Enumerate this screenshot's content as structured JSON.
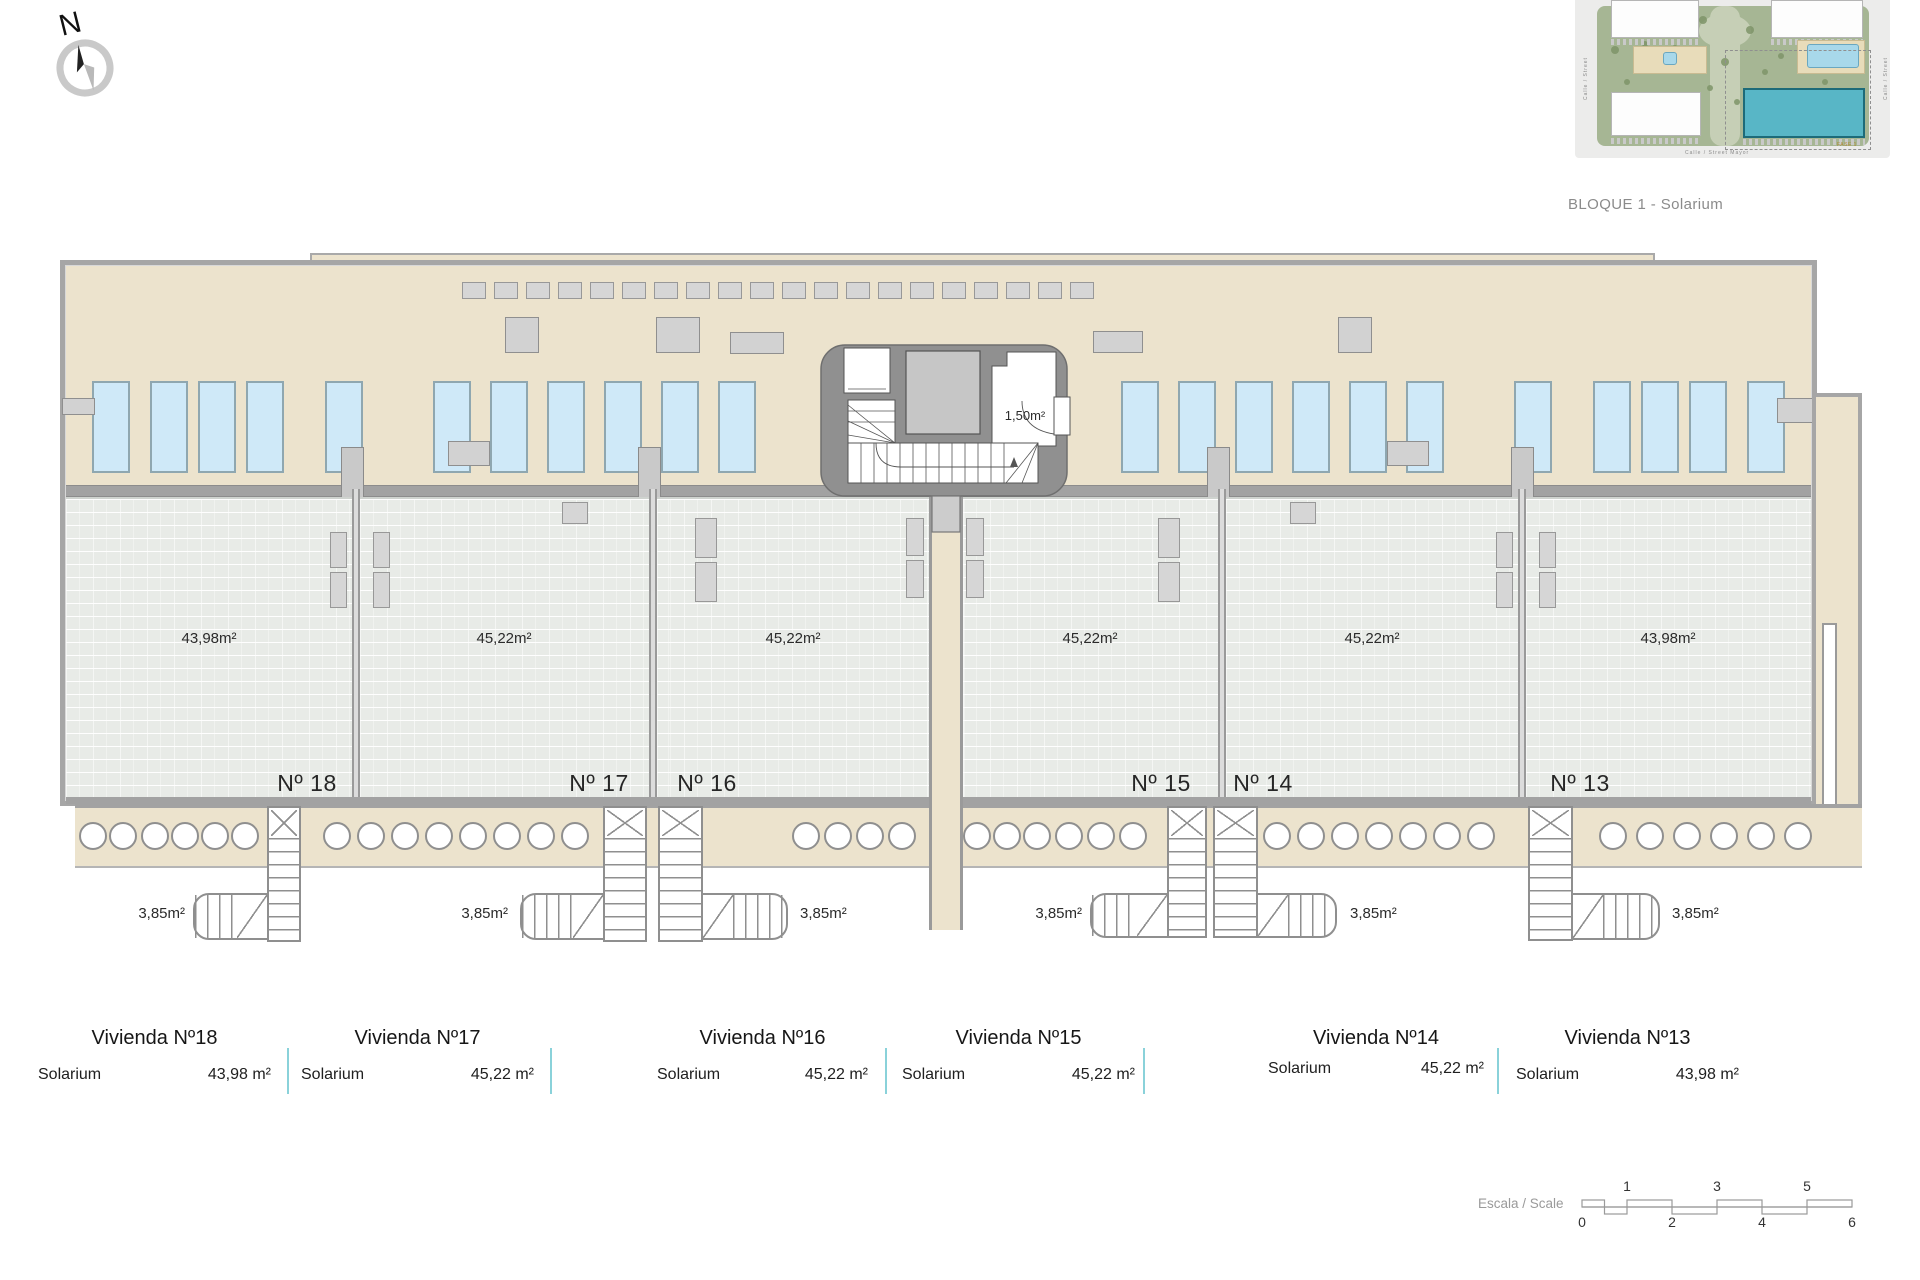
{
  "colors": {
    "beige": "#ece3cd",
    "brick": "#e8ebe7",
    "wall": "#a2a2a2",
    "pool_fill": "#cfe9f8",
    "pool_border": "#8fa7b0",
    "core_gray": "#909090",
    "table_divider": "#8ad2da",
    "caption_gray": "#8b8b8b"
  },
  "compass": {
    "label": "N"
  },
  "site_plan": {
    "caption": "BLOQUE 1 - Solarium",
    "streets": {
      "bottom": "Calle / Street  Mayor",
      "left": "Calle / Street",
      "right": "Calle / Street"
    },
    "phase_label": "FASE 1",
    "trees": [
      [
        40,
        50,
        4
      ],
      [
        52,
        82,
        3
      ],
      [
        128,
        20,
        4
      ],
      [
        150,
        62,
        4
      ],
      [
        162,
        102,
        3
      ],
      [
        175,
        30,
        4
      ],
      [
        190,
        72,
        3
      ],
      [
        206,
        56,
        3
      ],
      [
        60,
        120,
        4
      ],
      [
        100,
        48,
        3
      ],
      [
        120,
        116,
        4
      ],
      [
        250,
        82,
        3
      ],
      [
        212,
        122,
        3
      ],
      [
        284,
        62,
        3
      ],
      [
        70,
        44,
        3
      ],
      [
        240,
        34,
        3
      ],
      [
        95,
        95,
        3
      ],
      [
        135,
        88,
        3
      ]
    ]
  },
  "plan": {
    "shell": [
      60,
      260,
      1757,
      546
    ],
    "parapet": [
      310,
      253,
      1345,
      15
    ],
    "deck": [
      66,
      266,
      1745,
      219
    ],
    "wall_band": [
      66,
      485,
      1745,
      12
    ],
    "wall_bottom": [
      66,
      797,
      1745,
      7
    ],
    "right_wing": [
      1812,
      393,
      50,
      475
    ],
    "wing_slot": [
      1822,
      623,
      15,
      184
    ],
    "walkway": [
      75,
      804,
      1787,
      64
    ],
    "corridor": [
      929,
      490,
      34,
      440
    ],
    "pools": {
      "y": 381,
      "w": 38,
      "h": 92,
      "lefts": [
        92,
        150,
        198,
        246,
        325,
        433,
        490,
        547,
        604,
        661,
        718,
        1121,
        1178,
        1235,
        1292,
        1349,
        1406,
        1514,
        1593,
        1641,
        1689,
        1747
      ]
    },
    "loungers_top": {
      "start": 462,
      "y": 282,
      "w": 24,
      "h": 17,
      "pitch": 32,
      "count": 20
    },
    "deck_tables": [
      [
        505,
        317,
        34,
        36
      ],
      [
        656,
        317,
        44,
        36
      ],
      [
        730,
        332,
        54,
        22
      ],
      [
        1093,
        331,
        50,
        22
      ],
      [
        1338,
        317,
        34,
        36
      ],
      [
        62,
        398,
        33,
        17
      ],
      [
        1777,
        398,
        36,
        25
      ],
      [
        448,
        441,
        42,
        25
      ],
      [
        1387,
        441,
        42,
        25
      ]
    ],
    "divider_walls": [
      352,
      649,
      1218,
      1518
    ],
    "divider_pillars": [
      [
        341,
        447
      ],
      [
        638,
        447
      ],
      [
        1207,
        447
      ],
      [
        1511,
        447
      ]
    ],
    "terrace_items": [
      [
        330,
        532,
        17,
        36
      ],
      [
        330,
        572,
        17,
        36
      ],
      [
        373,
        532,
        17,
        36
      ],
      [
        373,
        572,
        17,
        36
      ],
      [
        695,
        518,
        22,
        40
      ],
      [
        695,
        562,
        22,
        40
      ],
      [
        906,
        518,
        18,
        38
      ],
      [
        906,
        560,
        18,
        38
      ],
      [
        966,
        518,
        18,
        38
      ],
      [
        966,
        560,
        18,
        38
      ],
      [
        1158,
        518,
        22,
        40
      ],
      [
        1158,
        562,
        22,
        40
      ],
      [
        1496,
        532,
        17,
        36
      ],
      [
        1496,
        572,
        17,
        36
      ],
      [
        1539,
        532,
        17,
        36
      ],
      [
        1539,
        572,
        17,
        36
      ],
      [
        562,
        502,
        26,
        22
      ],
      [
        1290,
        502,
        26,
        22
      ]
    ],
    "terraces": [
      {
        "x": 66,
        "w": 286,
        "area_label": "43,98m²",
        "area_cx": 209,
        "num_label": "Nº 18",
        "num_cx": 307
      },
      {
        "x": 360,
        "w": 289,
        "area_label": "45,22m²",
        "area_cx": 504,
        "num_label": "Nº 17",
        "num_cx": 599
      },
      {
        "x": 657,
        "w": 272,
        "area_label": "45,22m²",
        "area_cx": 793,
        "num_label": "Nº 16",
        "num_cx": 707
      },
      {
        "x": 963,
        "w": 255,
        "area_label": "45,22m²",
        "area_cx": 1090,
        "num_label": "Nº 15",
        "num_cx": 1161
      },
      {
        "x": 1226,
        "w": 292,
        "area_label": "45,22m²",
        "area_cx": 1372,
        "num_label": "Nº 14",
        "num_cx": 1263
      },
      {
        "x": 1526,
        "w": 285,
        "area_label": "43,98m²",
        "area_cx": 1668,
        "num_label": "Nº 13",
        "num_cx": 1580
      }
    ],
    "terrace_y": 497,
    "terrace_h": 303,
    "area_label_y": 630,
    "num_label_y": 770,
    "circles": {
      "cy": 836,
      "d": 28,
      "centers": [
        93,
        123,
        155,
        185,
        215,
        245,
        337,
        371,
        405,
        439,
        473,
        507,
        541,
        575,
        806,
        838,
        870,
        902,
        977,
        1007,
        1037,
        1069,
        1101,
        1133,
        1277,
        1311,
        1345,
        1379,
        1413,
        1447,
        1481,
        1613,
        1650,
        1687,
        1724,
        1761,
        1798
      ]
    },
    "stairs": [
      {
        "shaft": [
          267,
          806,
          34,
          136
        ],
        "run": [
          193,
          893,
          76,
          47
        ],
        "side": "left",
        "label": "3,85m²",
        "label_x": 185,
        "anchor": "end"
      },
      {
        "shaft": [
          603,
          806,
          44,
          136
        ],
        "run": [
          520,
          893,
          85,
          47
        ],
        "side": "left",
        "label": "3,85m²",
        "label_x": 508,
        "anchor": "end"
      },
      {
        "shaft": [
          658,
          806,
          45,
          136
        ],
        "run": [
          701,
          893,
          87,
          47
        ],
        "side": "right",
        "label": "3,85m²",
        "label_x": 800,
        "anchor": "start"
      },
      {
        "shaft": [
          1167,
          806,
          40,
          132
        ],
        "run": [
          1090,
          893,
          79,
          45
        ],
        "side": "left",
        "label": "3,85m²",
        "label_x": 1082,
        "anchor": "end"
      },
      {
        "shaft": [
          1213,
          806,
          45,
          132
        ],
        "run": [
          1256,
          893,
          81,
          45
        ],
        "side": "right",
        "label": "3,85m²",
        "label_x": 1350,
        "anchor": "start"
      },
      {
        "shaft": [
          1528,
          806,
          45,
          135
        ],
        "run": [
          1571,
          893,
          89,
          47
        ],
        "side": "right",
        "label": "3,85m²",
        "label_x": 1672,
        "anchor": "start"
      }
    ],
    "stair_label_y": 905,
    "core": {
      "x": 821,
      "y": 345,
      "wc_label": "1,50m²"
    }
  },
  "table": {
    "title_y": 1027,
    "row_y": 1066,
    "dividers_x": [
      287,
      550,
      885,
      1143,
      1497
    ],
    "divider_y": 1048,
    "divider_h": 46,
    "columns": [
      {
        "title": "Vivienda Nº18",
        "row_label": "Solarium",
        "value": "43,98 m²",
        "x": 36,
        "w": 237,
        "dy": 0
      },
      {
        "title": "Vivienda Nº17",
        "row_label": "Solarium",
        "value": "45,22 m²",
        "x": 299,
        "w": 237,
        "dy": 0
      },
      {
        "title": "Vivienda Nº16",
        "row_label": "Solarium",
        "value": "45,22 m²",
        "x": 655,
        "w": 215,
        "dy": 0
      },
      {
        "title": "Vivienda Nº15",
        "row_label": "Solarium",
        "value": "45,22 m²",
        "x": 900,
        "w": 237,
        "dy": 0
      },
      {
        "title": "Vivienda Nº14",
        "row_label": "Solarium",
        "value": "45,22 m²",
        "x": 1266,
        "w": 220,
        "dy": -6
      },
      {
        "title": "Vivienda Nº13",
        "row_label": "Solarium",
        "value": "43,98 m²",
        "x": 1514,
        "w": 227,
        "dy": 0
      }
    ]
  },
  "scale_bar": {
    "label": "Escala / Scale",
    "numbers_top": [
      {
        "t": "1",
        "x": 1627
      },
      {
        "t": "3",
        "x": 1717
      },
      {
        "t": "5",
        "x": 1807
      }
    ],
    "numbers_bottom": [
      {
        "t": "0",
        "x": 1582
      },
      {
        "t": "2",
        "x": 1672
      },
      {
        "t": "4",
        "x": 1762
      },
      {
        "t": "6",
        "x": 1852
      }
    ]
  }
}
